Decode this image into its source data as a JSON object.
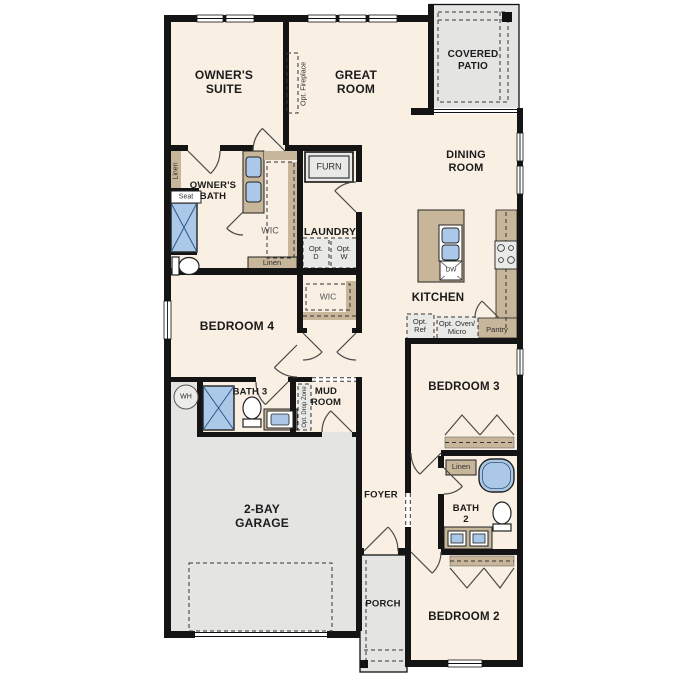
{
  "colors": {
    "floor": "#f9efe2",
    "outdoor": "#e4e4e2",
    "wall": "#141414",
    "cabinet": "#c8b69a",
    "fixture": "#abc8e8",
    "optional": "#e9e9e7"
  },
  "rooms": {
    "owners_suite": "OWNER'S\nSUITE",
    "great_room": "GREAT\nROOM",
    "covered_patio": "COVERED\nPATIO",
    "dining_room": "DINING\nROOM",
    "owners_bath": "OWNER'S\nBATH",
    "laundry": "LAUNDRY",
    "kitchen": "KITCHEN",
    "bedroom_4": "BEDROOM 4",
    "bath_3": "BATH 3",
    "mud_room": "MUD\nROOM",
    "bedroom_3": "BEDROOM 3",
    "bath_2": "BATH\n2",
    "garage": "2-BAY\nGARAGE",
    "foyer": "FOYER",
    "porch": "PORCH",
    "bedroom_2": "BEDROOM 2",
    "wic_owners": "WIC",
    "wic_bedroom4": "WIC"
  },
  "features": {
    "seat": "Seat",
    "linen_bath": "Linen",
    "linen_hall": "Linen",
    "linen_bath2": "Linen",
    "furn": "FURN",
    "opt_d": "Opt.\nD",
    "opt_w": "Opt.\nW",
    "opt_fireplace": "Opt. Fireplace",
    "opt_ref": "Opt.\nRef",
    "opt_oven_micro": "Opt. Oven/\nMicro",
    "pantry": "Pantry",
    "dw": "DW",
    "wh": "WH",
    "opt_drop_zone": "Opt. Drop Zone"
  }
}
